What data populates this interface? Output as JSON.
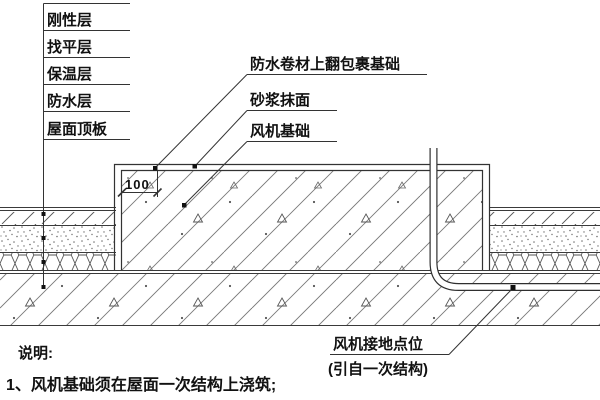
{
  "drawing_title": "风机基础屋面防水节点详图",
  "layers": {
    "items": [
      "刚性层",
      "找平层",
      "保温层",
      "防水层",
      "屋面顶板"
    ]
  },
  "callouts": {
    "membrane": "防水卷材上翻包裹基础",
    "mortar": "砂浆抹面",
    "foundation": "风机基础"
  },
  "grounding": {
    "line1": "风机接地点位",
    "line2": "(引自一次结构)"
  },
  "dimension": {
    "offset_label": "100"
  },
  "notes": {
    "heading": "说明:",
    "item1": "1、风机基础须在屋面一次结构上浇筑;"
  },
  "colors": {
    "background": "#ffffff",
    "line": "#333333",
    "hatch": "#777777",
    "text": "#111111"
  }
}
